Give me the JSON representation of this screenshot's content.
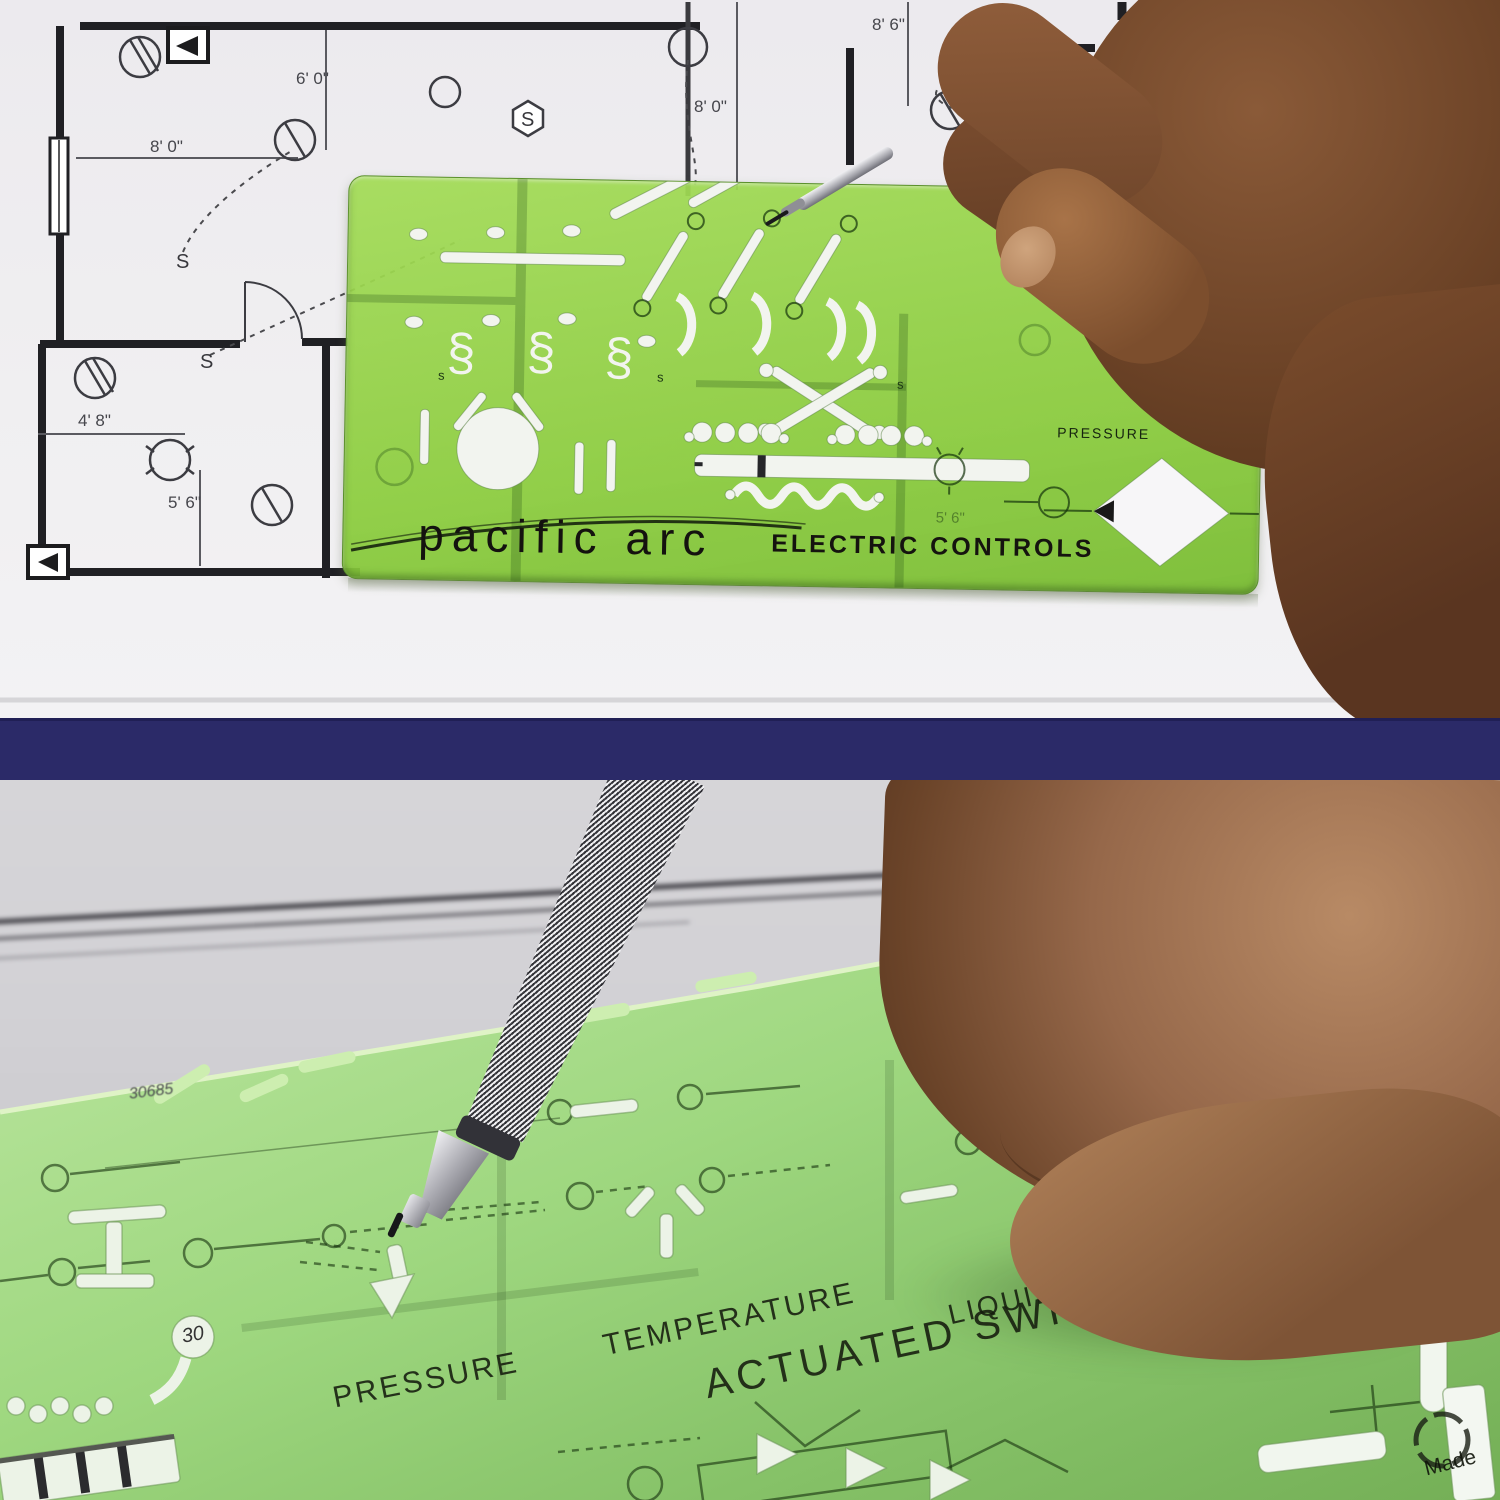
{
  "pencil": {
    "brand": "PACIFIC ARC",
    "model": "DP1007"
  },
  "top_panel": {
    "blueprint": {
      "dimensions": [
        "6' 0\"",
        "8' 0\"",
        "8' 6\"",
        "8' 0\"",
        "4' 8\"",
        "5' 6\""
      ],
      "switch_label": "S"
    },
    "template": {
      "brand": "pacific arc",
      "title": "ELECTRIC CONTROLS",
      "label_pressure": "PRESSURE",
      "label_te": "TE",
      "small_s": "s",
      "seen_dim": "5' 6\"",
      "cutout_glyph": "§"
    }
  },
  "bottom_panel": {
    "template": {
      "label_pressure": "PRESSURE",
      "label_temperature": "TEMPERATURE",
      "label_liquid_level": "LIQUID LEVEL",
      "label_actuated_switches": "ACTUATED SWITCHES",
      "label_foot": "FOOT",
      "label_flow": "FLOW",
      "label_made": "Made",
      "handwritten_30": "30",
      "handwritten_note": "30685"
    }
  },
  "colors": {
    "template_green": "#9ad64f",
    "divider_navy": "#2b2a68",
    "pencil_red": "#c1272d"
  }
}
